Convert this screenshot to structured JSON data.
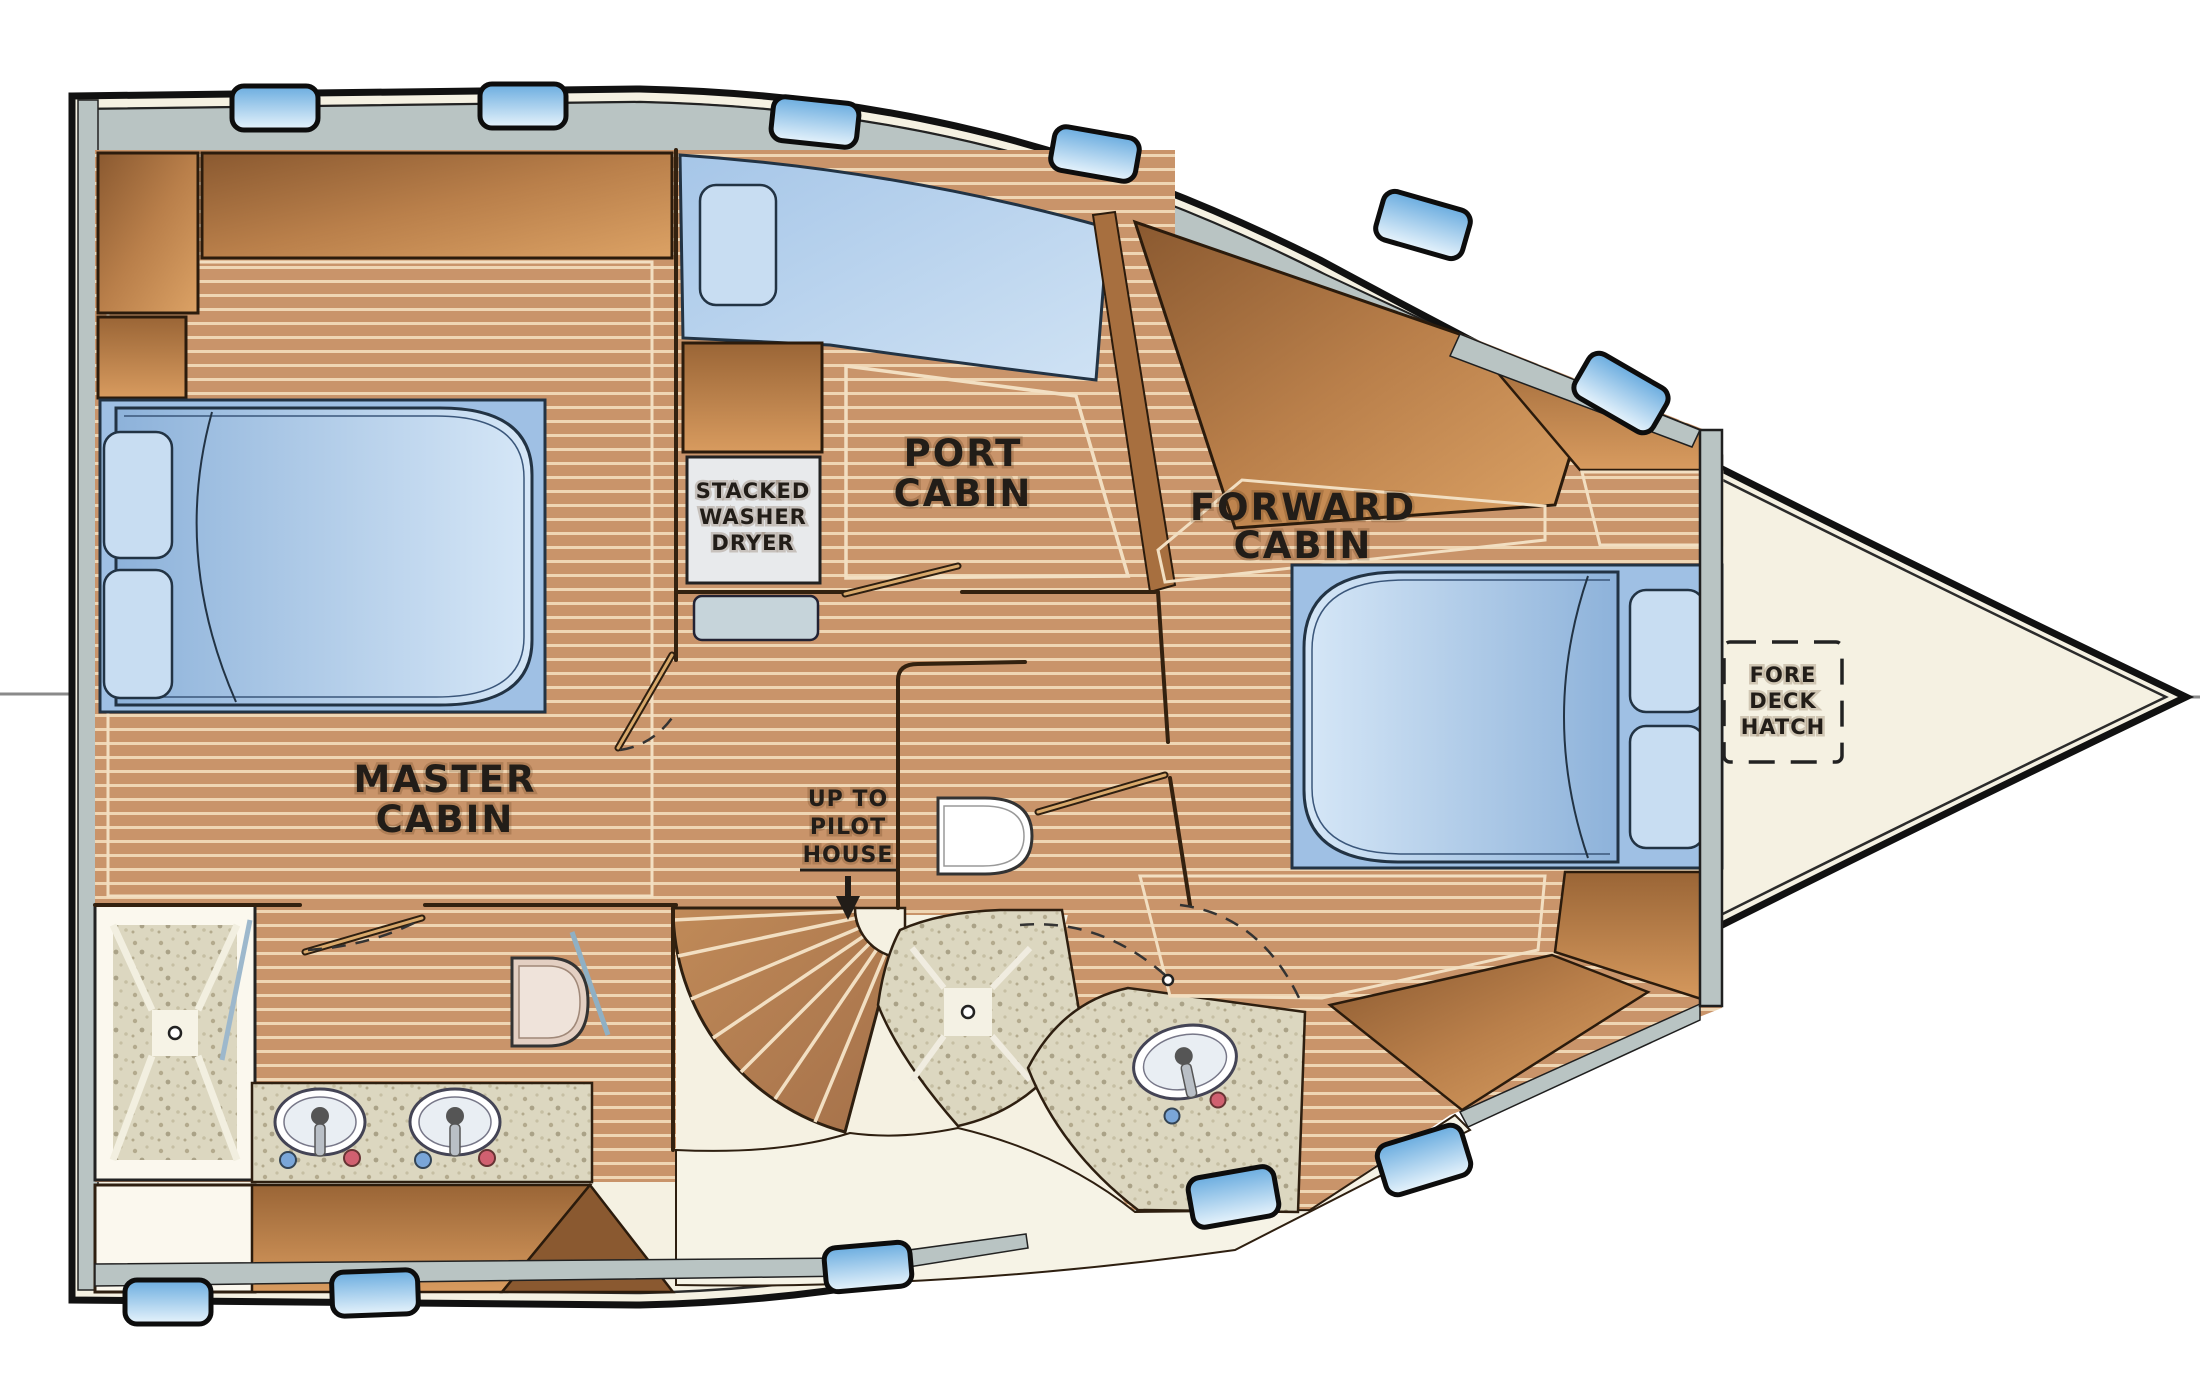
{
  "title": "Yacht lower deck floor plan",
  "labels": {
    "master_cabin": [
      "MASTER",
      "CABIN"
    ],
    "port_cabin": [
      "PORT",
      "CABIN"
    ],
    "forward_cabin": [
      "FORWARD",
      "CABIN"
    ],
    "washer": [
      "STACKED",
      "WASHER",
      "DRYER"
    ],
    "pilot_house": [
      "UP TO",
      "PILOT",
      "HOUSE"
    ],
    "fore_deck_hatch": [
      "FORE",
      "DECK",
      "HATCH"
    ]
  },
  "icons": {
    "down_arrow": "stairs-down-arrow",
    "shower_drain": "shower-drain",
    "sink": "sink-basin",
    "cold_tap": "cold-water-knob",
    "hot_tap": "hot-water-knob"
  },
  "colors": {
    "page_bg": "#ffffff",
    "hull_deck": "#f5f1e2",
    "hull_outline": "#111111",
    "walkway_gray": "#b9c4c3",
    "floor_wood": "#c9946a",
    "floor_stripe": "#efd6b4",
    "stairs_wood": "#b67f52",
    "cabinet_dark": "#8a5930",
    "cabinet_mid": "#b97f4a",
    "cabinet_light": "#dca265",
    "bed_blue": "#8db2da",
    "bed_blue_light": "#d6e7f7",
    "pillow_blue": "#c8ddf2",
    "window_blue": "#6aacdf",
    "granite": "#dcd7c0",
    "granite_speck": "#b3aa8d",
    "fixture_white": "#ffffff",
    "label_ink": "#221d18",
    "cold_tap": "#7aa6d8",
    "hot_tap": "#d06070"
  }
}
